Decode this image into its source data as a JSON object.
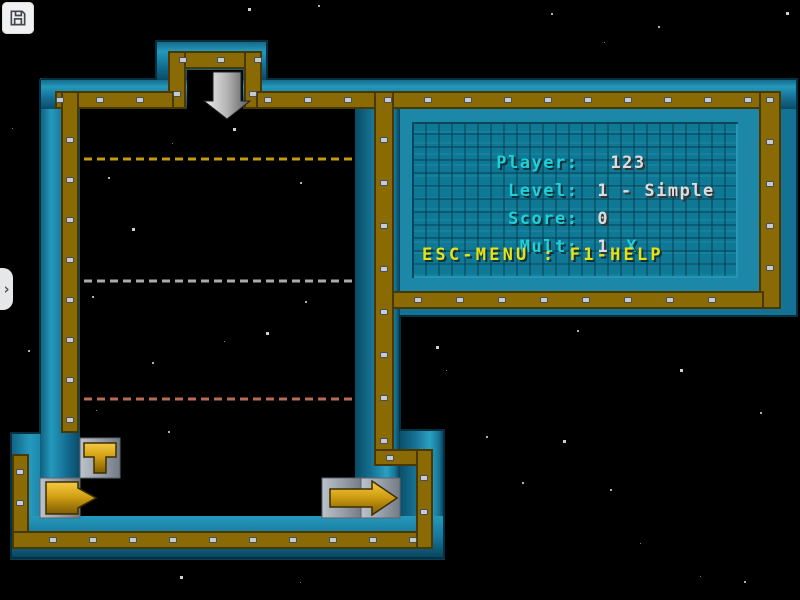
{
  "window": {
    "width": 800,
    "height": 600,
    "background": "#000000"
  },
  "toolbar": {
    "save_icon": "floppy-disk"
  },
  "drawer": {
    "chevron": "›"
  },
  "hud": {
    "lines": [
      {
        "label": "Player:",
        "value": "123"
      },
      {
        "label": "Level:",
        "value": "1 - Simple"
      },
      {
        "label": "Score:",
        "value": "0"
      },
      {
        "label": "Mult:",
        "value": "1",
        "value2": "X"
      }
    ],
    "help_text": "ESC-MENU : F1-HELP"
  },
  "game": {
    "guide_lines": [
      {
        "name": "gold-dashed-line",
        "y": 159,
        "color": "#c49a10"
      },
      {
        "name": "gray-dashed-line",
        "y": 281,
        "color": "#aaaaaa"
      },
      {
        "name": "red-dashed-line",
        "y": 399,
        "color": "#b76b58"
      }
    ],
    "pieces": [
      {
        "name": "t-pipe-piece"
      },
      {
        "name": "plug-piece"
      },
      {
        "name": "right-arrow-piece"
      }
    ],
    "drop_indicator": "down-arrow"
  },
  "colors": {
    "wall_teal": "#16749a",
    "wall_gold": "#8a6a05",
    "panel_bg": "#0f7894",
    "label_cyan": "#1fd0d8",
    "value_white": "#dcdcdc",
    "help_yellow": "#e8e215",
    "tile_gray": "#9aa1ab",
    "piece_gold": "#d2a014",
    "arrow_gray": "#b4b4b4",
    "rivet_gray": "#c6cad1"
  },
  "stars": [
    [
      248,
      8
    ],
    [
      551,
      13
    ],
    [
      658,
      26
    ],
    [
      604,
      42
    ],
    [
      786,
      12
    ],
    [
      318,
      5
    ],
    [
      12,
      128
    ],
    [
      28,
      350
    ],
    [
      233,
      128
    ],
    [
      172,
      143
    ],
    [
      108,
      177
    ],
    [
      300,
      182
    ],
    [
      132,
      228
    ],
    [
      92,
      296
    ],
    [
      305,
      301
    ],
    [
      224,
      341
    ],
    [
      266,
      332
    ],
    [
      152,
      362
    ],
    [
      96,
      410
    ],
    [
      168,
      431
    ],
    [
      436,
      346
    ],
    [
      446,
      370
    ],
    [
      486,
      436
    ],
    [
      522,
      482
    ],
    [
      563,
      440
    ],
    [
      577,
      330
    ],
    [
      610,
      489
    ],
    [
      640,
      543
    ],
    [
      680,
      369
    ],
    [
      760,
      412
    ],
    [
      700,
      576
    ],
    [
      744,
      581
    ],
    [
      180,
      576
    ],
    [
      300,
      582
    ]
  ]
}
